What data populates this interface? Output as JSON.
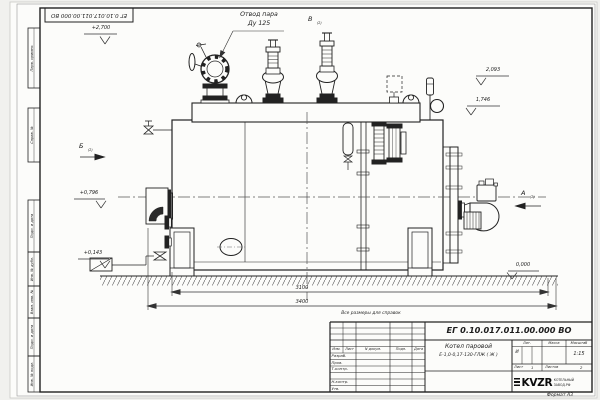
{
  "sheet": {
    "format_note": "Формат А3",
    "reference_note": "Все размеры для справок"
  },
  "drawing": {
    "callout": {
      "line1": "Отвод пара",
      "line2": "Ду 125"
    },
    "views": {
      "a": "А",
      "b": "Б",
      "v": "В",
      "sub": "(2)"
    },
    "elevations": {
      "top": "+2,700",
      "e2093": "2,093",
      "e1746": "1,746",
      "e0796": "+0,796",
      "e0143": "+0,143",
      "zero": "0,000"
    },
    "dimensions": {
      "inner": "3100",
      "overall": "3400"
    }
  },
  "title_block": {
    "doc_number": "ЕГ 0.10.017.011.00.000  ВО",
    "product_name": "Котел паровой",
    "product_model": "Е-1,0-0,17-130-ГЛЖ ( Ж )",
    "columns": {
      "izm": "Изм.",
      "list": "Лист",
      "doc": "N докум.",
      "podp": "Подп.",
      "data": "Дата"
    },
    "rows": {
      "razrab": "Разраб.",
      "prov": "Пров.",
      "tkontr": "Т.контр.",
      "nkontr": "Н.контр.",
      "utv": "Утв."
    },
    "lit": {
      "header": "Лит.",
      "value": "И"
    },
    "massa": {
      "header": "Масса"
    },
    "scale": {
      "header": "Масштаб",
      "value": "1:15"
    },
    "sheet_no": {
      "label": "Лист",
      "value": "1"
    },
    "sheets_total": {
      "label": "Листов",
      "value": "2"
    },
    "company": {
      "logo": "KVZR",
      "line1": "КОТЕЛЬНЫЙ",
      "line2": "ЗАВОД.РФ"
    }
  },
  "margin": {
    "stamp_top": "ЕГ 0.10.017.011.00.000  ВО",
    "labels": [
      "Перв. примен.",
      "Справ. №",
      "Подп. и дата",
      "Инв. № дубл.",
      "Взам. инв. №",
      "Подп. и дата",
      "Инв. № подл."
    ]
  }
}
